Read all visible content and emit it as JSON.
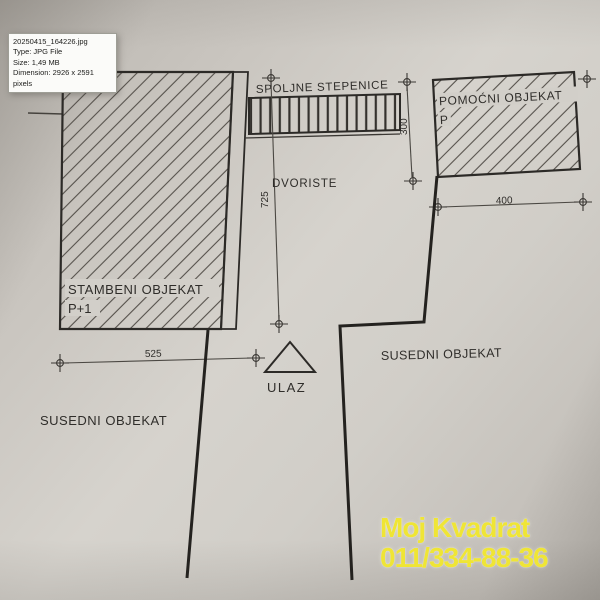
{
  "tooltip": {
    "filename": "20250415_164226.jpg",
    "type": "Type: JPG File",
    "size": "Size: 1,49 MB",
    "dimension": "Dimension: 2926 x 2591 pixels"
  },
  "plan": {
    "labels": {
      "external_stairs": "SPOLJNE STEPENICE",
      "auxiliary_building": "POMOĆNI OBJEKAT",
      "auxiliary_floor": "P",
      "courtyard": "DVORISTE",
      "residential_building": "STAMBENI OBJEKAT",
      "residential_floor": "P+1",
      "neighbor_left": "SUSEDNI OBJEKAT",
      "neighbor_right": "SUSEDNI OBJEKAT",
      "entrance": "ULAZ"
    },
    "dimensions": {
      "front_width": "525",
      "yard_depth": "725",
      "stairs_length": "300",
      "rear_width": "400"
    },
    "colors": {
      "paper": "#d3d0ca",
      "ink": "#35322e"
    }
  },
  "watermark": {
    "line1": "Moj Kvadrat",
    "line2": "011/334-88-36",
    "color": "#efe535"
  }
}
